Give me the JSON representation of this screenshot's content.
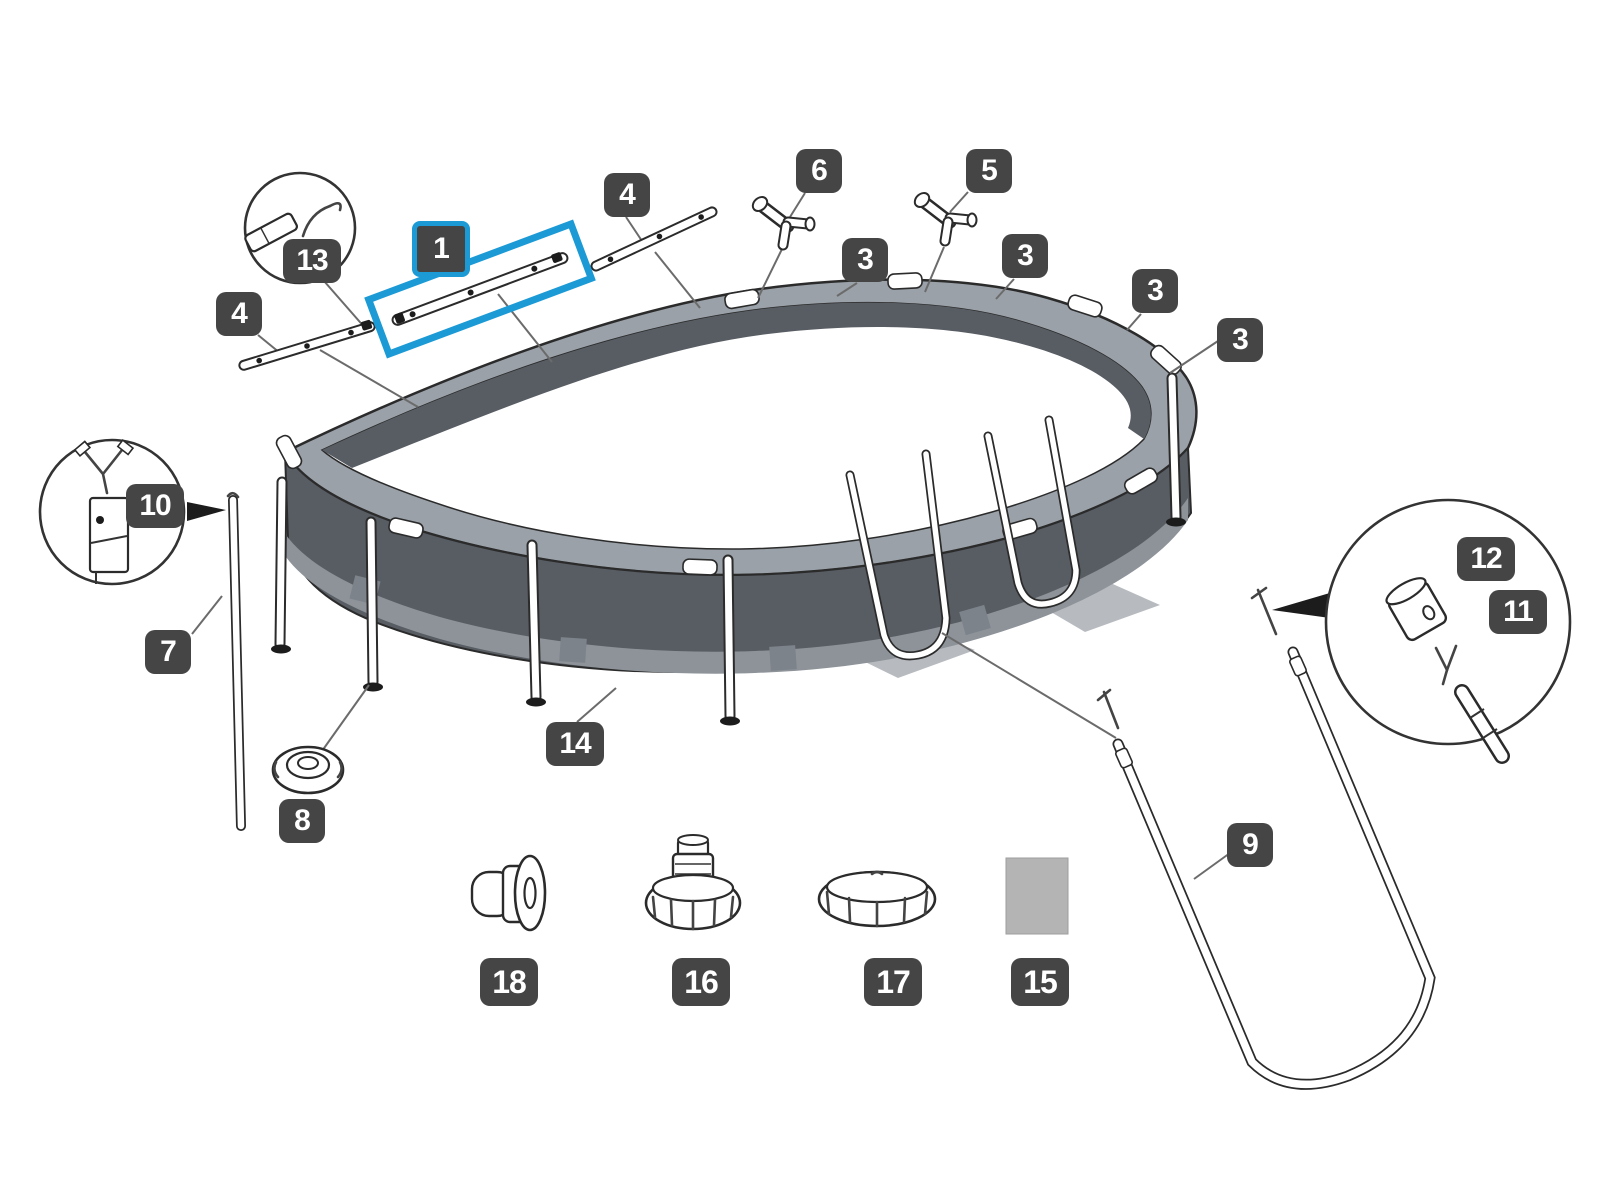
{
  "diagram": {
    "kind": "exploded-parts-diagram",
    "subject": "oval frame pool",
    "background": "#ffffff"
  },
  "colors": {
    "page_bg": "#ffffff",
    "callout_bg": "#454545",
    "callout_text": "#ffffff",
    "highlight_blue": "#1b9ad6",
    "pool_wall": "#585d64",
    "pool_band": "#8d9399",
    "pool_rim": "#9aa1a8",
    "outline": "#2b2b2b",
    "leader": "#6b6b6b",
    "patch_gray": "#b4b4b4"
  },
  "callouts": {
    "part1": {
      "number": "1",
      "highlighted": true
    },
    "part3a": {
      "number": "3"
    },
    "part3b": {
      "number": "3"
    },
    "part3c": {
      "number": "3"
    },
    "part3d": {
      "number": "3"
    },
    "part4_left": {
      "number": "4"
    },
    "part4_top": {
      "number": "4"
    },
    "part5": {
      "number": "5"
    },
    "part6": {
      "number": "6"
    },
    "part7": {
      "number": "7"
    },
    "part8": {
      "number": "8"
    },
    "part9": {
      "number": "9"
    },
    "part10": {
      "number": "10"
    },
    "part11": {
      "number": "11"
    },
    "part12": {
      "number": "12"
    },
    "part13": {
      "number": "13"
    },
    "part14": {
      "number": "14"
    },
    "part15": {
      "number": "15"
    },
    "part16": {
      "number": "16"
    },
    "part17": {
      "number": "17"
    },
    "part18": {
      "number": "18"
    }
  }
}
